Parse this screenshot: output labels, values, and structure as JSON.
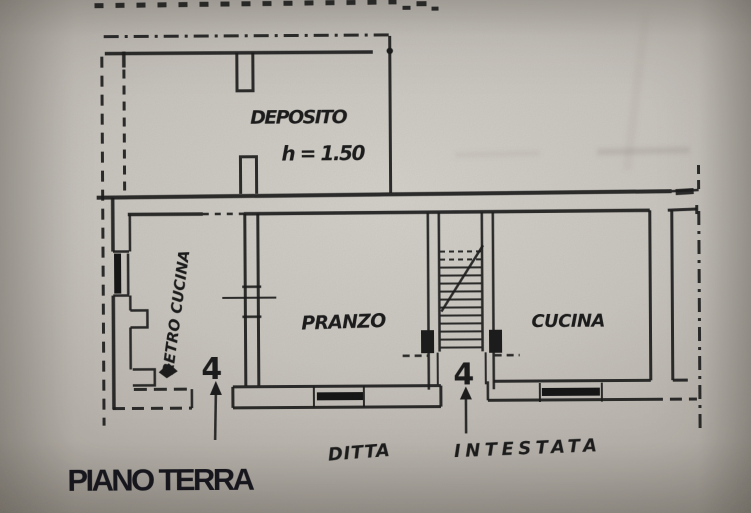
{
  "plan": {
    "title": "PIANO TERRA",
    "rooms": [
      {
        "name": "DEPOSITO",
        "note": "h = 1.50"
      },
      {
        "name": "RETRO CUCINA"
      },
      {
        "name": "PRANZO"
      },
      {
        "name": "CUCINA"
      }
    ],
    "labels": {
      "ditta": "DITTA",
      "intestata": "INTESTATA"
    },
    "markers": {
      "left": "4",
      "right": "4"
    },
    "colors": {
      "ink": "#1d1d1d",
      "paper_light": "#d7d4ce",
      "paper_dark": "#9c968e",
      "title_ink": "#15151c"
    }
  }
}
